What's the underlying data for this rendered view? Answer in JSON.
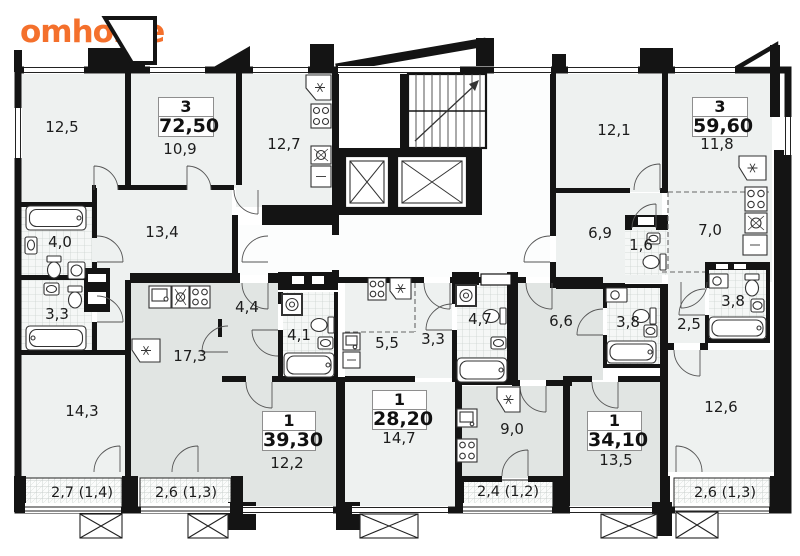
{
  "logo": {
    "text": "omhome",
    "color": "#f4702c"
  },
  "colors": {
    "wall": "#141414",
    "room_light": "#eef1f0",
    "room_selected_grey": "#e1e5e3",
    "tile_base": "#f5f7f6",
    "balcony_base": "#fbfcfb",
    "logo_orange": "#f4702c",
    "label_text": "#1c1c1c"
  },
  "apartments": [
    {
      "rooms": "3",
      "area": "72,50"
    },
    {
      "rooms": "1",
      "area": "39,30"
    },
    {
      "rooms": "1",
      "area": "28,20"
    },
    {
      "rooms": "1",
      "area": "34,10"
    },
    {
      "rooms": "3",
      "area": "59,60"
    }
  ],
  "rooms": [
    {
      "name": "living-12-5",
      "area": "12,5"
    },
    {
      "name": "bedroom-10-9",
      "area": "10,9"
    },
    {
      "name": "kitchen-12-7",
      "area": "12,7"
    },
    {
      "name": "room-13-4",
      "area": "13,4"
    },
    {
      "name": "bath-4-0",
      "area": "4,0"
    },
    {
      "name": "wc-3-3",
      "area": "3,3"
    },
    {
      "name": "kitchen-17-3",
      "area": "17,3"
    },
    {
      "name": "hall-4-4",
      "area": "4,4"
    },
    {
      "name": "bath-4-1",
      "area": "4,1"
    },
    {
      "name": "room-14-3",
      "area": "14,3"
    },
    {
      "name": "room-12-2",
      "area": "12,2"
    },
    {
      "name": "room-14-7",
      "area": "14,7"
    },
    {
      "name": "kitchen-5-5",
      "area": "5,5"
    },
    {
      "name": "hall-3-3",
      "area": "3,3"
    },
    {
      "name": "bath-4-7",
      "area": "4,7"
    },
    {
      "name": "kitchen-9-0",
      "area": "9,0"
    },
    {
      "name": "hall-6-6",
      "area": "6,6"
    },
    {
      "name": "bath-3-8",
      "area": "3,8"
    },
    {
      "name": "room-13-5",
      "area": "13,5"
    },
    {
      "name": "hall-2-5",
      "area": "2,5"
    },
    {
      "name": "bath-3-8b",
      "area": "3,8"
    },
    {
      "name": "wc-1-6",
      "area": "1,6"
    },
    {
      "name": "hall-6-9",
      "area": "6,9"
    },
    {
      "name": "room-12-1",
      "area": "12,1"
    },
    {
      "name": "room-11-8",
      "area": "11,8"
    },
    {
      "name": "kitchen-7-0",
      "area": "7,0"
    },
    {
      "name": "room-12-6",
      "area": "12,6"
    }
  ],
  "balconies": [
    {
      "name": "balcony-left",
      "label": "2,7 (1,4)"
    },
    {
      "name": "balcony-center-left",
      "label": "2,6 (1,3)"
    },
    {
      "name": "balcony-center-right",
      "label": "2,4 (1,2)"
    },
    {
      "name": "balcony-right",
      "label": "2,6 (1,3)"
    }
  ]
}
